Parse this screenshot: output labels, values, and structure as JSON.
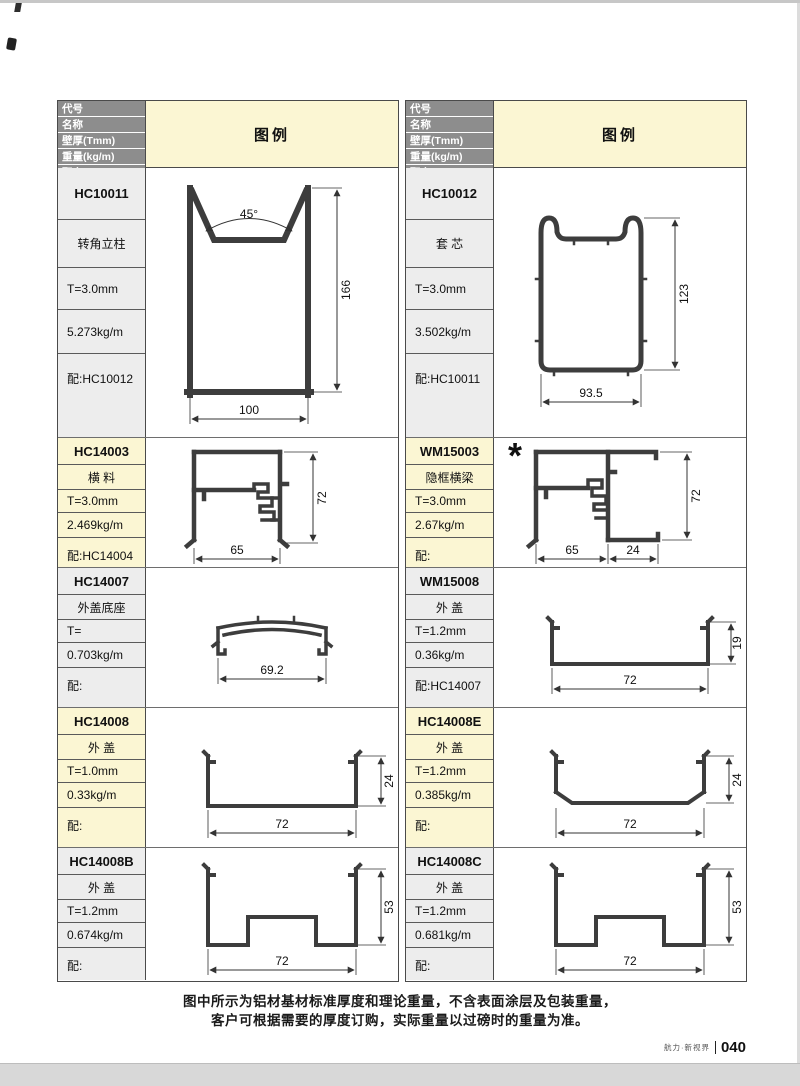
{
  "header": {
    "row_labels": [
      "代号",
      "名称",
      "壁厚(Tmm)",
      "重量(kg/m)",
      "配套"
    ],
    "legend_label": "图例"
  },
  "colors": {
    "header_cell_bg": "#8d8d8d",
    "legend_bg": "#fbf6d3",
    "label_bg_gray": "#ededed",
    "label_bg_yellow": "#fbf6d3",
    "line_color": "#3d3d3d"
  },
  "columns": [
    {
      "sections": [
        {
          "code": "HC10011",
          "name": "转角立柱",
          "thickness": "T=3.0mm",
          "weight": "5.273kg/m",
          "match": "配:HC10012",
          "dims": {
            "angle": "45°",
            "height": "166",
            "width": "100"
          }
        },
        {
          "code": "HC14003",
          "name": "横 料",
          "thickness": "T=3.0mm",
          "weight": "2.469kg/m",
          "match": "配:HC14004",
          "dims": {
            "height": "72",
            "width": "65"
          }
        },
        {
          "code": "HC14007",
          "name": "外盖底座",
          "thickness": "T=",
          "weight": "0.703kg/m",
          "match": "配:",
          "dims": {
            "width": "69.2"
          }
        },
        {
          "code": "HC14008",
          "name": "外 盖",
          "thickness": "T=1.0mm",
          "weight": "0.33kg/m",
          "match": "配:",
          "dims": {
            "height": "24",
            "width": "72"
          }
        },
        {
          "code": "HC14008B",
          "name": "外 盖",
          "thickness": "T=1.2mm",
          "weight": "0.674kg/m",
          "match": "配:",
          "dims": {
            "height": "53",
            "width": "72"
          }
        }
      ]
    },
    {
      "sections": [
        {
          "code": "HC10012",
          "name": "套 芯",
          "thickness": "T=3.0mm",
          "weight": "3.502kg/m",
          "match": "配:HC10011",
          "dims": {
            "height": "123",
            "width": "93.5"
          }
        },
        {
          "code": "WM15003",
          "name": "隐框横梁",
          "thickness": "T=3.0mm",
          "weight": "2.67kg/m",
          "match": "配:",
          "note_mark": "*",
          "dims": {
            "height": "72",
            "width": "65",
            "width2": "24"
          }
        },
        {
          "code": "WM15008",
          "name": "外 盖",
          "thickness": "T=1.2mm",
          "weight": "0.36kg/m",
          "match": "配:HC14007",
          "dims": {
            "height": "19",
            "width": "72"
          }
        },
        {
          "code": "HC14008E",
          "name": "外 盖",
          "thickness": "T=1.2mm",
          "weight": "0.385kg/m",
          "match": "配:",
          "dims": {
            "height": "24",
            "width": "72"
          }
        },
        {
          "code": "HC14008C",
          "name": "外 盖",
          "thickness": "T=1.2mm",
          "weight": "0.681kg/m",
          "match": "配:",
          "dims": {
            "height": "53",
            "width": "72"
          }
        }
      ]
    }
  ],
  "footer": {
    "note_line1": "图中所示为铝材基材标准厚度和理论重量，不含表面涂层及包装重量，",
    "note_line2": "客户可根据需要的厚度订购，实际重量以过磅时的重量为准。",
    "brand": "航力·新视界",
    "page_number": "040"
  }
}
